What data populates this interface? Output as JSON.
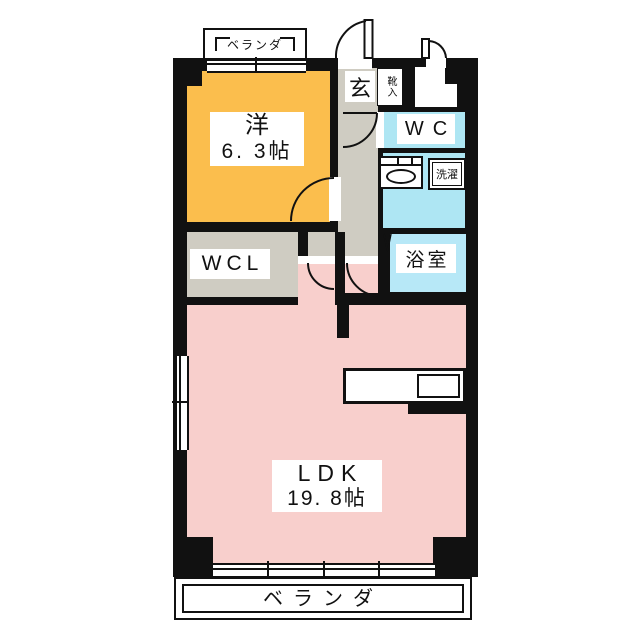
{
  "title": "apartment-floor-plan",
  "rooms": {
    "western": {
      "name_label": "洋",
      "size_label": "6. 3帖"
    },
    "ldk": {
      "name_label": "LDK",
      "size_label": "19. 8帖"
    },
    "wcl": {
      "label": "WCL"
    },
    "wc": {
      "label": "WC"
    },
    "bathroom": {
      "label": "浴室"
    },
    "laundry": {
      "label": "洗濯"
    },
    "entrance": {
      "label": "玄"
    },
    "shoe_storage": {
      "label": "靴入"
    },
    "veranda_top": {
      "label": "ベランダ"
    },
    "veranda_bottom": {
      "label": "ベランダ"
    }
  },
  "colors": {
    "wall": "#111111",
    "western_room": "#FBBE4D",
    "ldk": "#F8CFCC",
    "hallway": "#CFCCC2",
    "wcl": "#CFCCC2",
    "water_rooms": "#AEE6F3",
    "bathroom": "#B7E8F7",
    "label_bg": "#FFFFFF"
  }
}
